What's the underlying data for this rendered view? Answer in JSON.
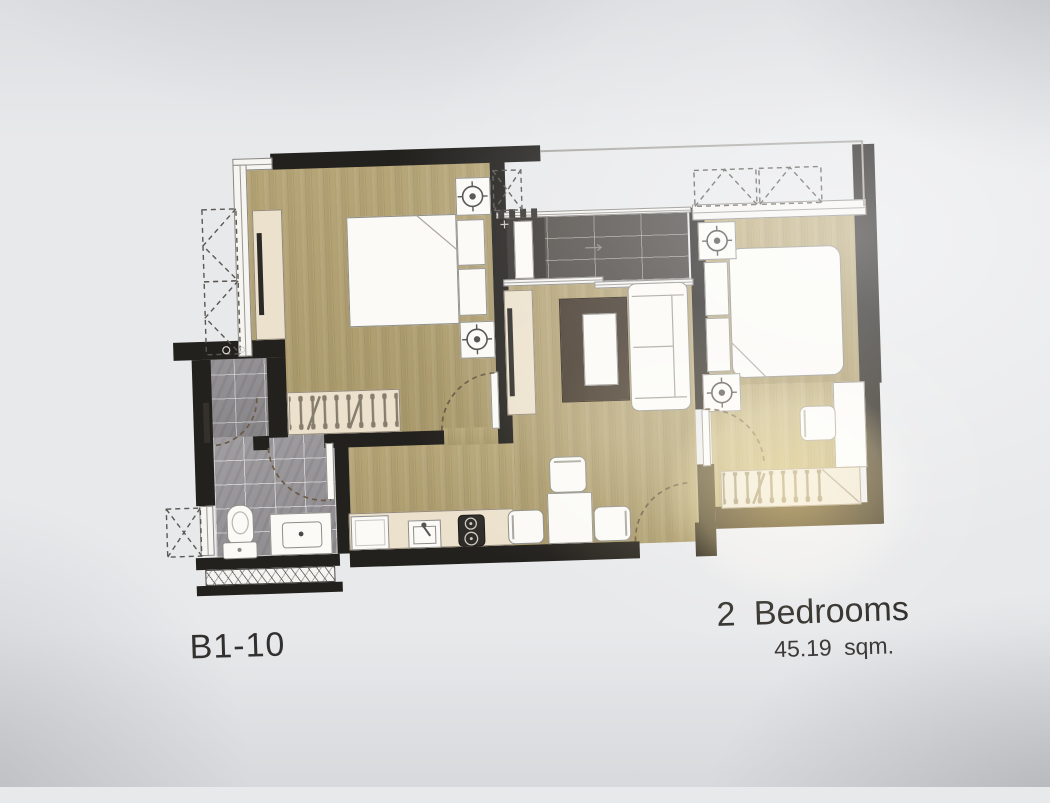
{
  "labels": {
    "unit_code": "B1-10",
    "unit_type": "2 Bedrooms",
    "unit_area": "45.19 sqm."
  },
  "colors": {
    "paper": "#e8e9eb",
    "wall": "#23211e",
    "wood": "#b2a173",
    "balcony_tile": "#4b4743",
    "bath_tile": "#989599",
    "cream": "#ece1cc",
    "white_furniture": "#fbfaf6",
    "rug": "#3b2f25",
    "door_arc": "#6b5a45",
    "glare": "#ffd678",
    "text": "#312f2d"
  }
}
